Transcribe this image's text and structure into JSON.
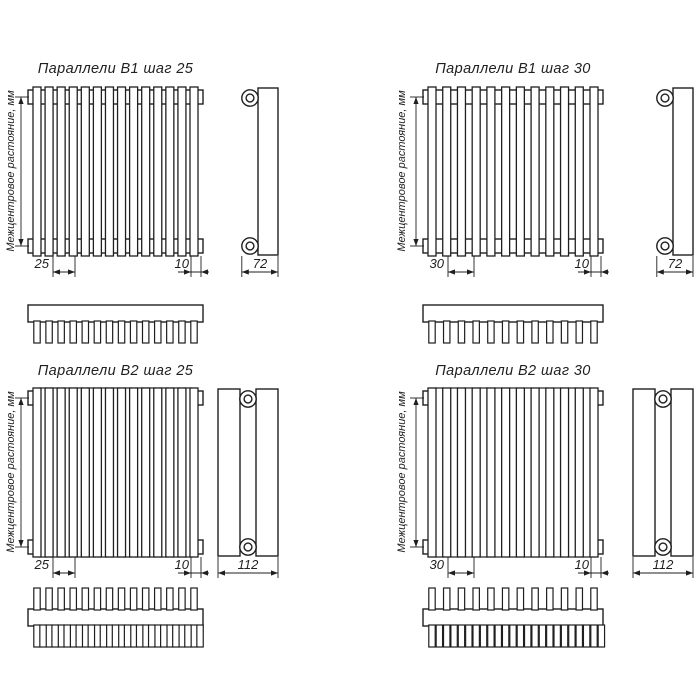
{
  "meta": {
    "sheet_background": "#ffffff",
    "line_color": "#1f1f1f"
  },
  "vertical_axis_label": "Межцентровое растояние, мм",
  "panels": [
    {
      "id": "b1-step-25",
      "title": "Параллели В1 шаг 25",
      "series": "В1",
      "step_mm": "25",
      "tube_width_mm": "10",
      "depth_mm": "72",
      "tube_count": 14,
      "rows": 1
    },
    {
      "id": "b1-step-30",
      "title": "Параллели В1 шаг 30",
      "series": "В1",
      "step_mm": "30",
      "tube_width_mm": "10",
      "depth_mm": "72",
      "tube_count": 12,
      "rows": 1
    },
    {
      "id": "b2-step-25",
      "title": "Параллели В2 шаг 25",
      "series": "В2",
      "step_mm": "25",
      "tube_width_mm": "10",
      "depth_mm": "112",
      "tube_count": 14,
      "rows": 2
    },
    {
      "id": "b2-step-30",
      "title": "Параллели В2 шаг 30",
      "series": "В2",
      "step_mm": "30",
      "tube_width_mm": "10",
      "depth_mm": "112",
      "tube_count": 12,
      "rows": 2
    }
  ]
}
